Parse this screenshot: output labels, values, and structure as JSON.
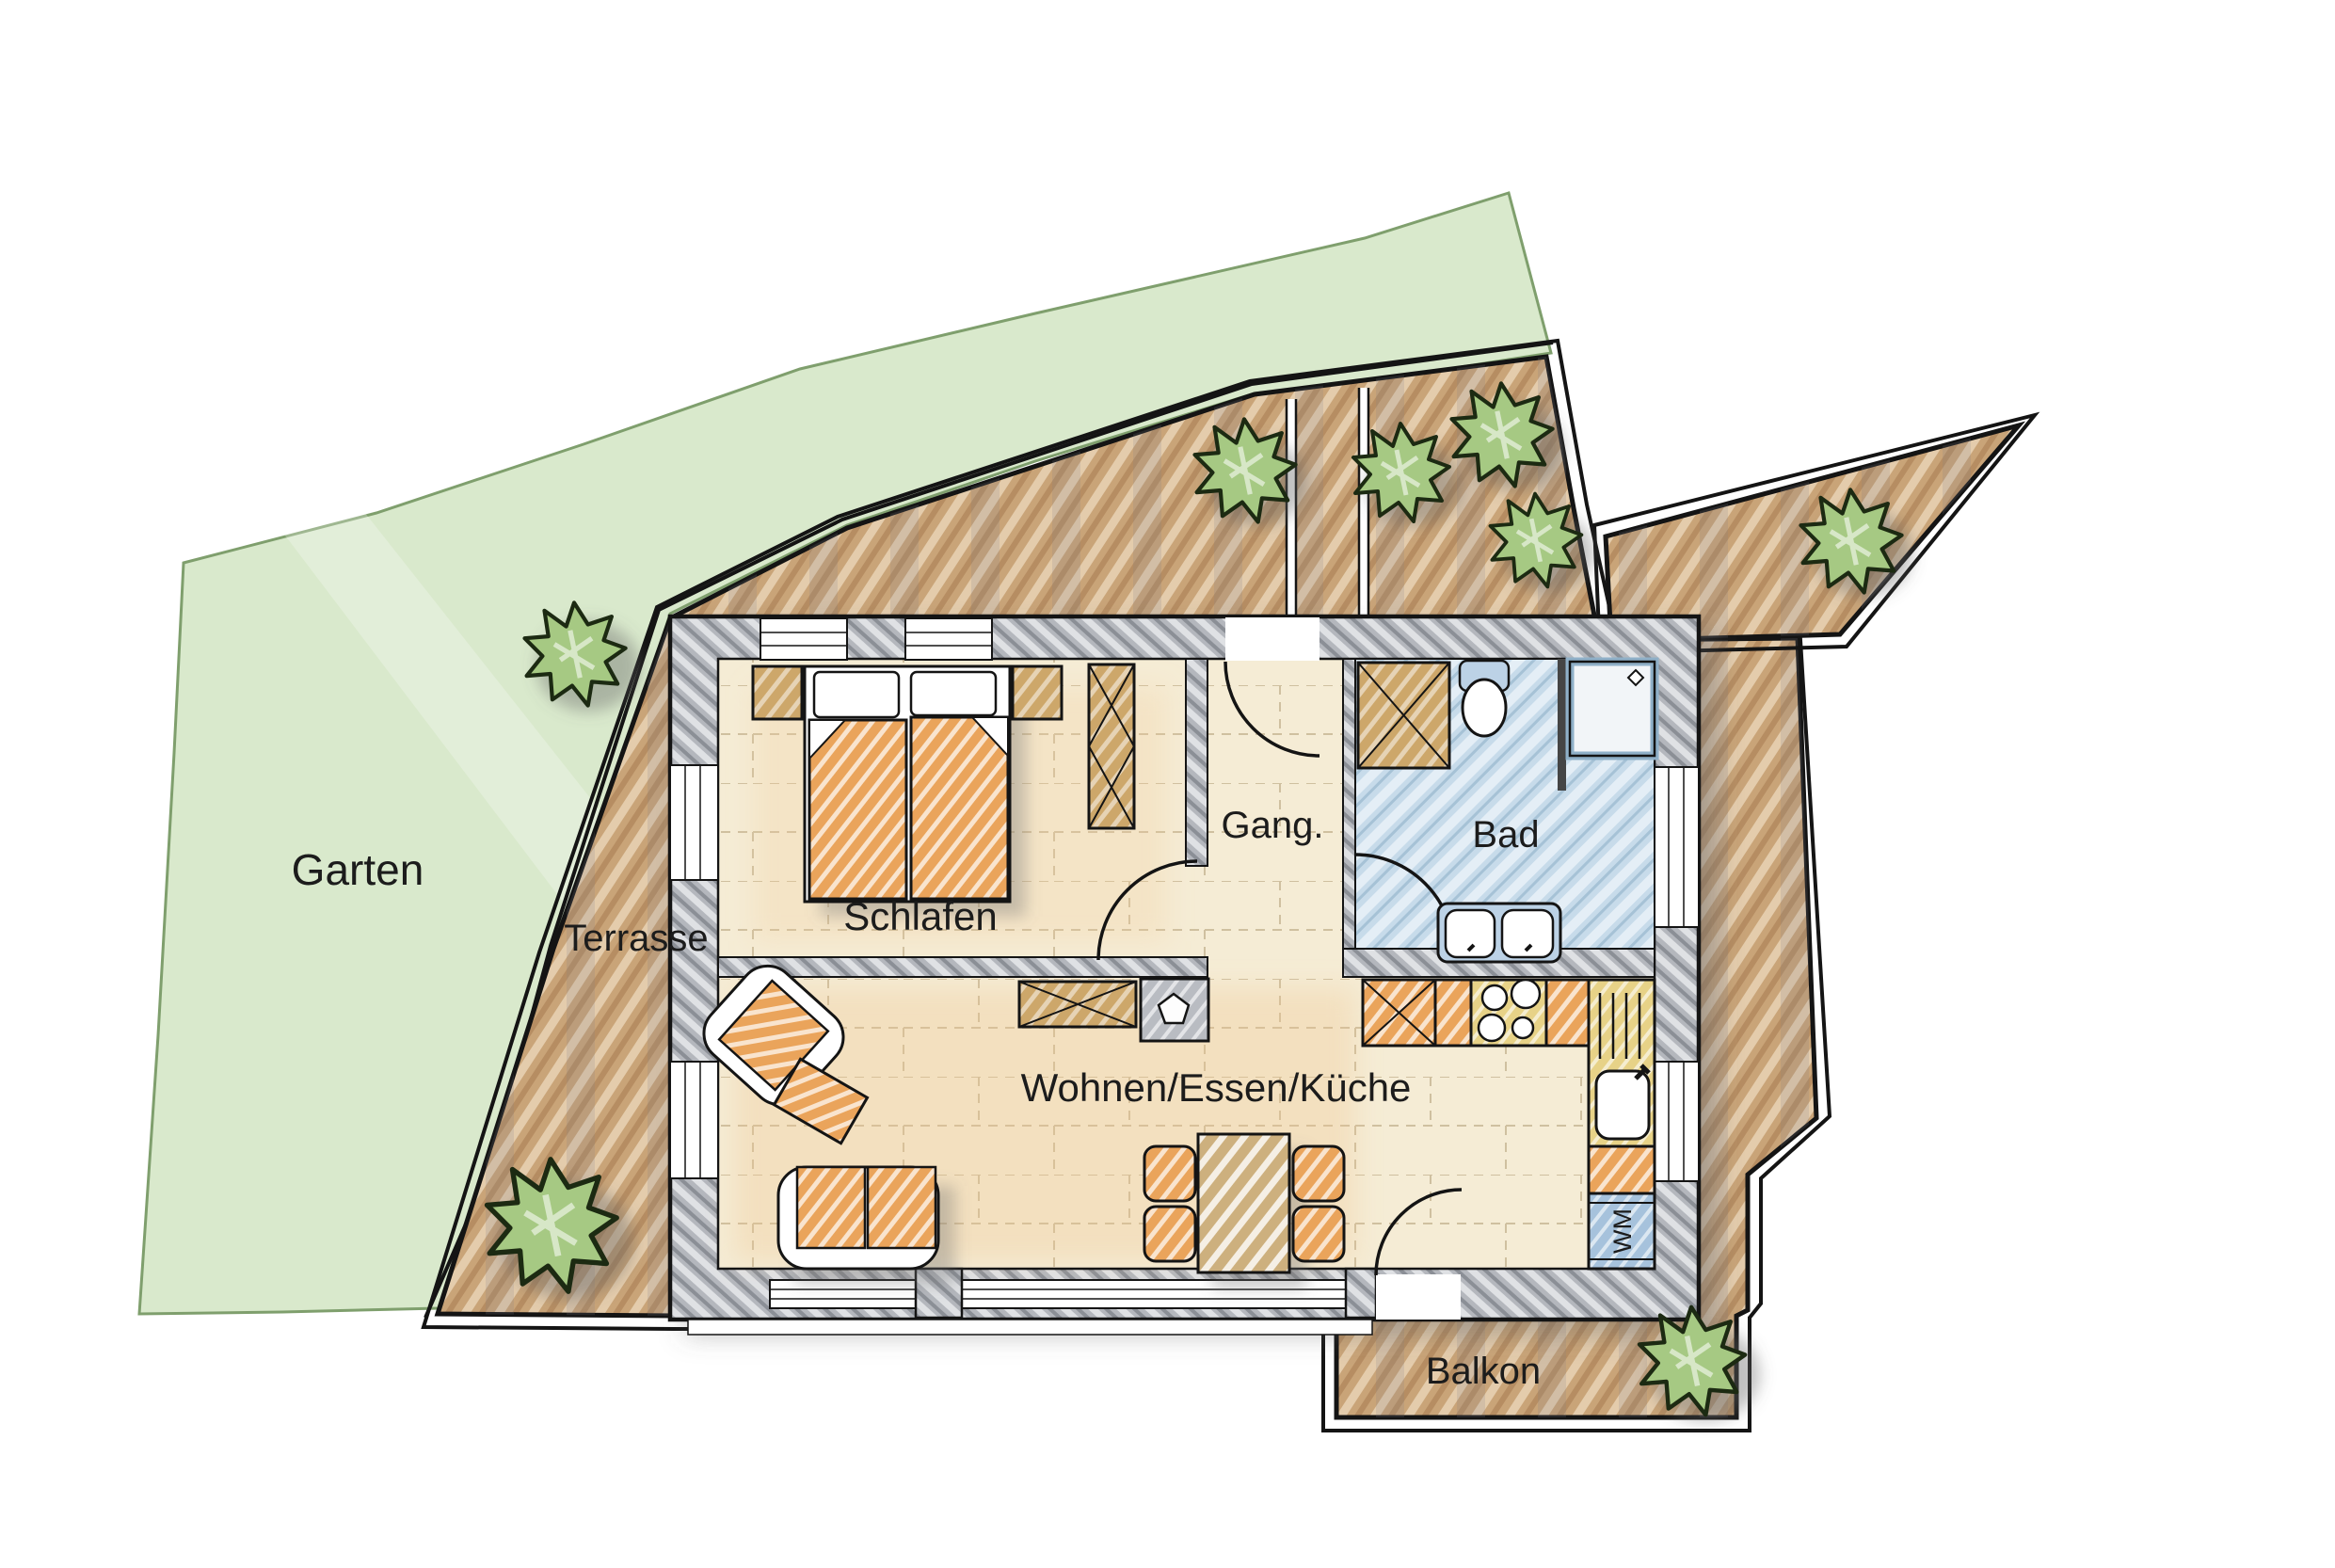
{
  "labels": {
    "garden": "Garten",
    "terrace": "Terrasse",
    "bedroom": "Schlafen",
    "hallway": "Gang.",
    "bathroom": "Bad",
    "living_dining_kitchen": "Wohnen/Essen/Küche",
    "balcony": "Balkon",
    "washing_machine": "WM"
  },
  "colors": {
    "garden_fill": "#d9e9cc",
    "garden_border": "#7f9f6d",
    "terrace_fill": "#c9a478",
    "terrace_stripe_light": "#e9d4b5",
    "terrace_stripe_dark": "#b2875c",
    "wall_fill": "#b4b7bd",
    "floor_fill": "#f5ecd5",
    "bathroom_floor": "#c7dbea",
    "furniture_orange": "#eaa45b",
    "furniture_tan": "#cda76a",
    "kitchen_yellow": "#e7d287",
    "appliance_blue": "#a6c2dc",
    "bush_green": "#a6c983",
    "outline": "#141414"
  }
}
